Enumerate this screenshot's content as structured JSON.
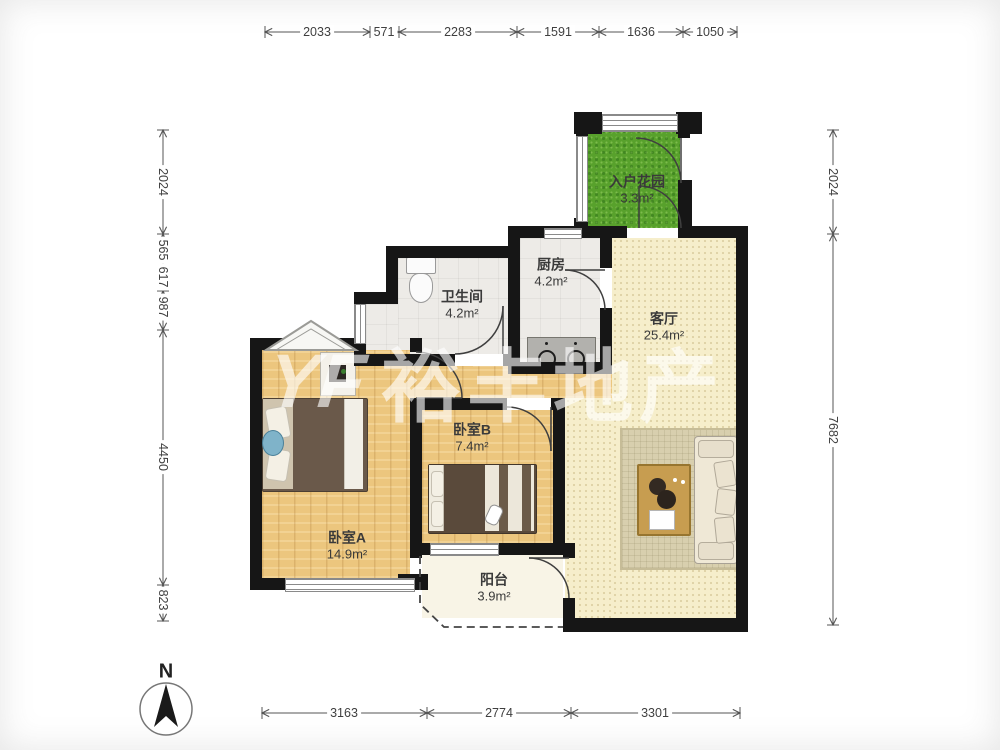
{
  "title": "两室户型平面图",
  "rooms": {
    "entry_garden": {
      "name": "入户花园",
      "area": "3.3m²"
    },
    "kitchen": {
      "name": "厨房",
      "area": "4.2m²"
    },
    "bathroom": {
      "name": "卫生间",
      "area": "4.2m²"
    },
    "living_room": {
      "name": "客厅",
      "area": "25.4m²"
    },
    "bedroom_b": {
      "name": "卧室B",
      "area": "7.4m²"
    },
    "bedroom_a": {
      "name": "卧室A",
      "area": "14.9m²"
    },
    "balcony": {
      "name": "阳台",
      "area": "3.9m²"
    }
  },
  "dimensions": {
    "top": [
      "2033",
      "571",
      "2283",
      "1591",
      "1636",
      "1050"
    ],
    "bottom": [
      "3163",
      "2774",
      "3301"
    ],
    "left": [
      "2024",
      "565",
      "617",
      "987",
      "4450",
      "823"
    ],
    "right": [
      "2024",
      "7682"
    ]
  },
  "watermark": {
    "logo": "YF",
    "text": "裕丰地产"
  },
  "compass": {
    "label": "N"
  },
  "colors": {
    "wall": "#161616",
    "wood": "#ecc67e",
    "living": "#f6eecb",
    "grayfloor": "#edebe7",
    "garden": "#58a12c",
    "balcony": "#f8f4e6",
    "labelcolor": "#3a3a3a"
  }
}
